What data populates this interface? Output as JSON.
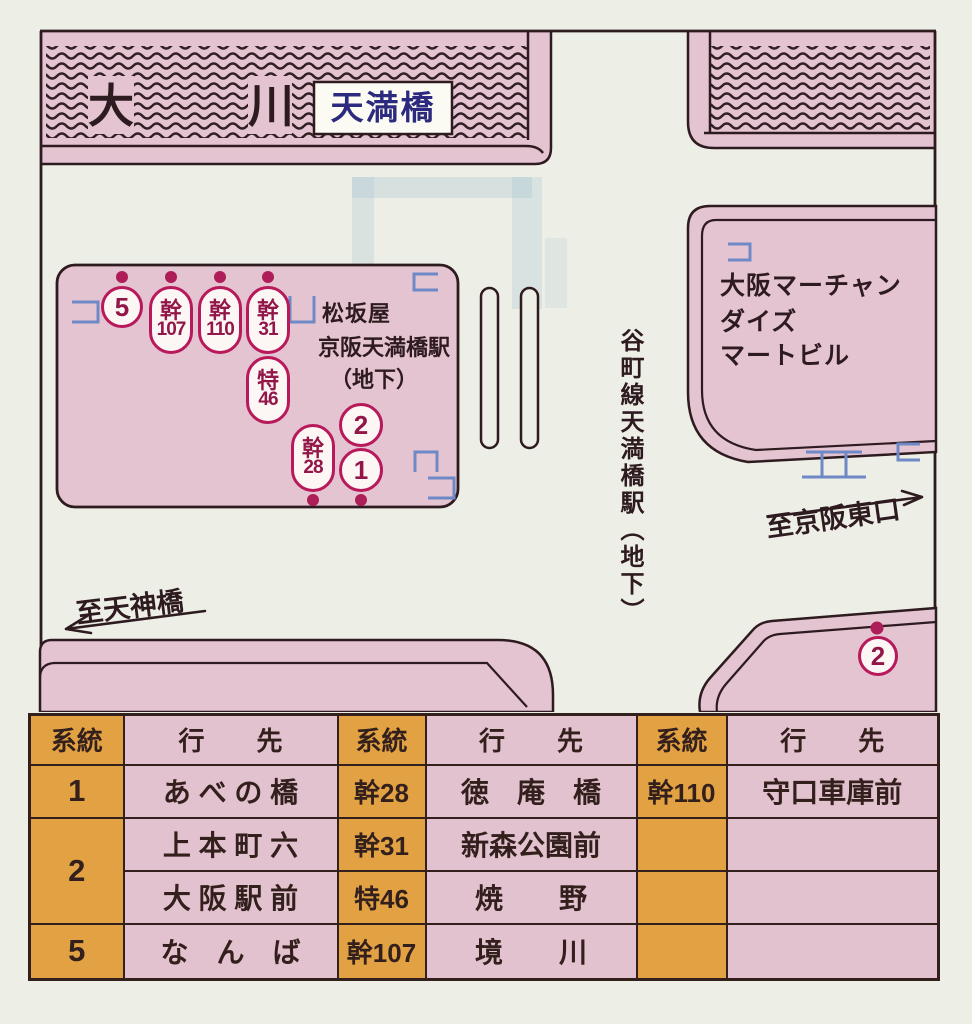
{
  "colors": {
    "background": "#edeee5",
    "block_pink": "#e5c4d2",
    "table_pink": "#e3c2d0",
    "table_orange": "#e2a243",
    "line_dark": "#2e1b20",
    "badge_crimson": "#b7195a",
    "badge_text": "#931648",
    "entrance_blue": "#6f88c6",
    "bridge_label_navy": "#2c2a7e"
  },
  "map": {
    "river": {
      "name_left": "大",
      "name_right": "川",
      "bridge_label": "天満橋"
    },
    "labels": {
      "matsuzakaya": "松坂屋",
      "keihan_station": "京阪天満橋駅",
      "keihan_station_note": "（地下）",
      "building_line1": "大阪マーチャン",
      "building_line2": "ダイズ",
      "building_line3": "マートビル",
      "to_keihan_east": "至京阪東口",
      "to_tenjinbashi": "至天神橋",
      "tanimachi_station": "谷町線天満橋駅（地下）"
    },
    "stops": {
      "s5": {
        "top": "5"
      },
      "k107": {
        "top": "幹",
        "num": "107"
      },
      "k110": {
        "top": "幹",
        "num": "110"
      },
      "k31": {
        "top": "幹",
        "num": "31"
      },
      "t46": {
        "top": "特",
        "num": "46"
      },
      "k28": {
        "top": "幹",
        "num": "28"
      },
      "s2": {
        "top": "2"
      },
      "s1": {
        "top": "1"
      },
      "s2b": {
        "top": "2"
      }
    }
  },
  "table": {
    "header": {
      "keito": "系統",
      "yukisaki": "行　　先"
    },
    "rows": [
      {
        "c0": "1",
        "c1": "あ べ の 橋",
        "c2": "幹28",
        "c3": "徳　庵　橋",
        "c4": "幹110",
        "c5": "守口車庫前"
      },
      {
        "c0": "2",
        "c1": "上 本 町 六",
        "c2": "幹31",
        "c3": "新森公園前",
        "c4": "",
        "c5": ""
      },
      {
        "c1": "大 阪 駅 前",
        "c2": "特46",
        "c3": "焼　　野",
        "c4": "",
        "c5": ""
      },
      {
        "c0": "5",
        "c1": "な　ん　ば",
        "c2": "幹107",
        "c3": "境　　川",
        "c4": "",
        "c5": ""
      }
    ]
  }
}
